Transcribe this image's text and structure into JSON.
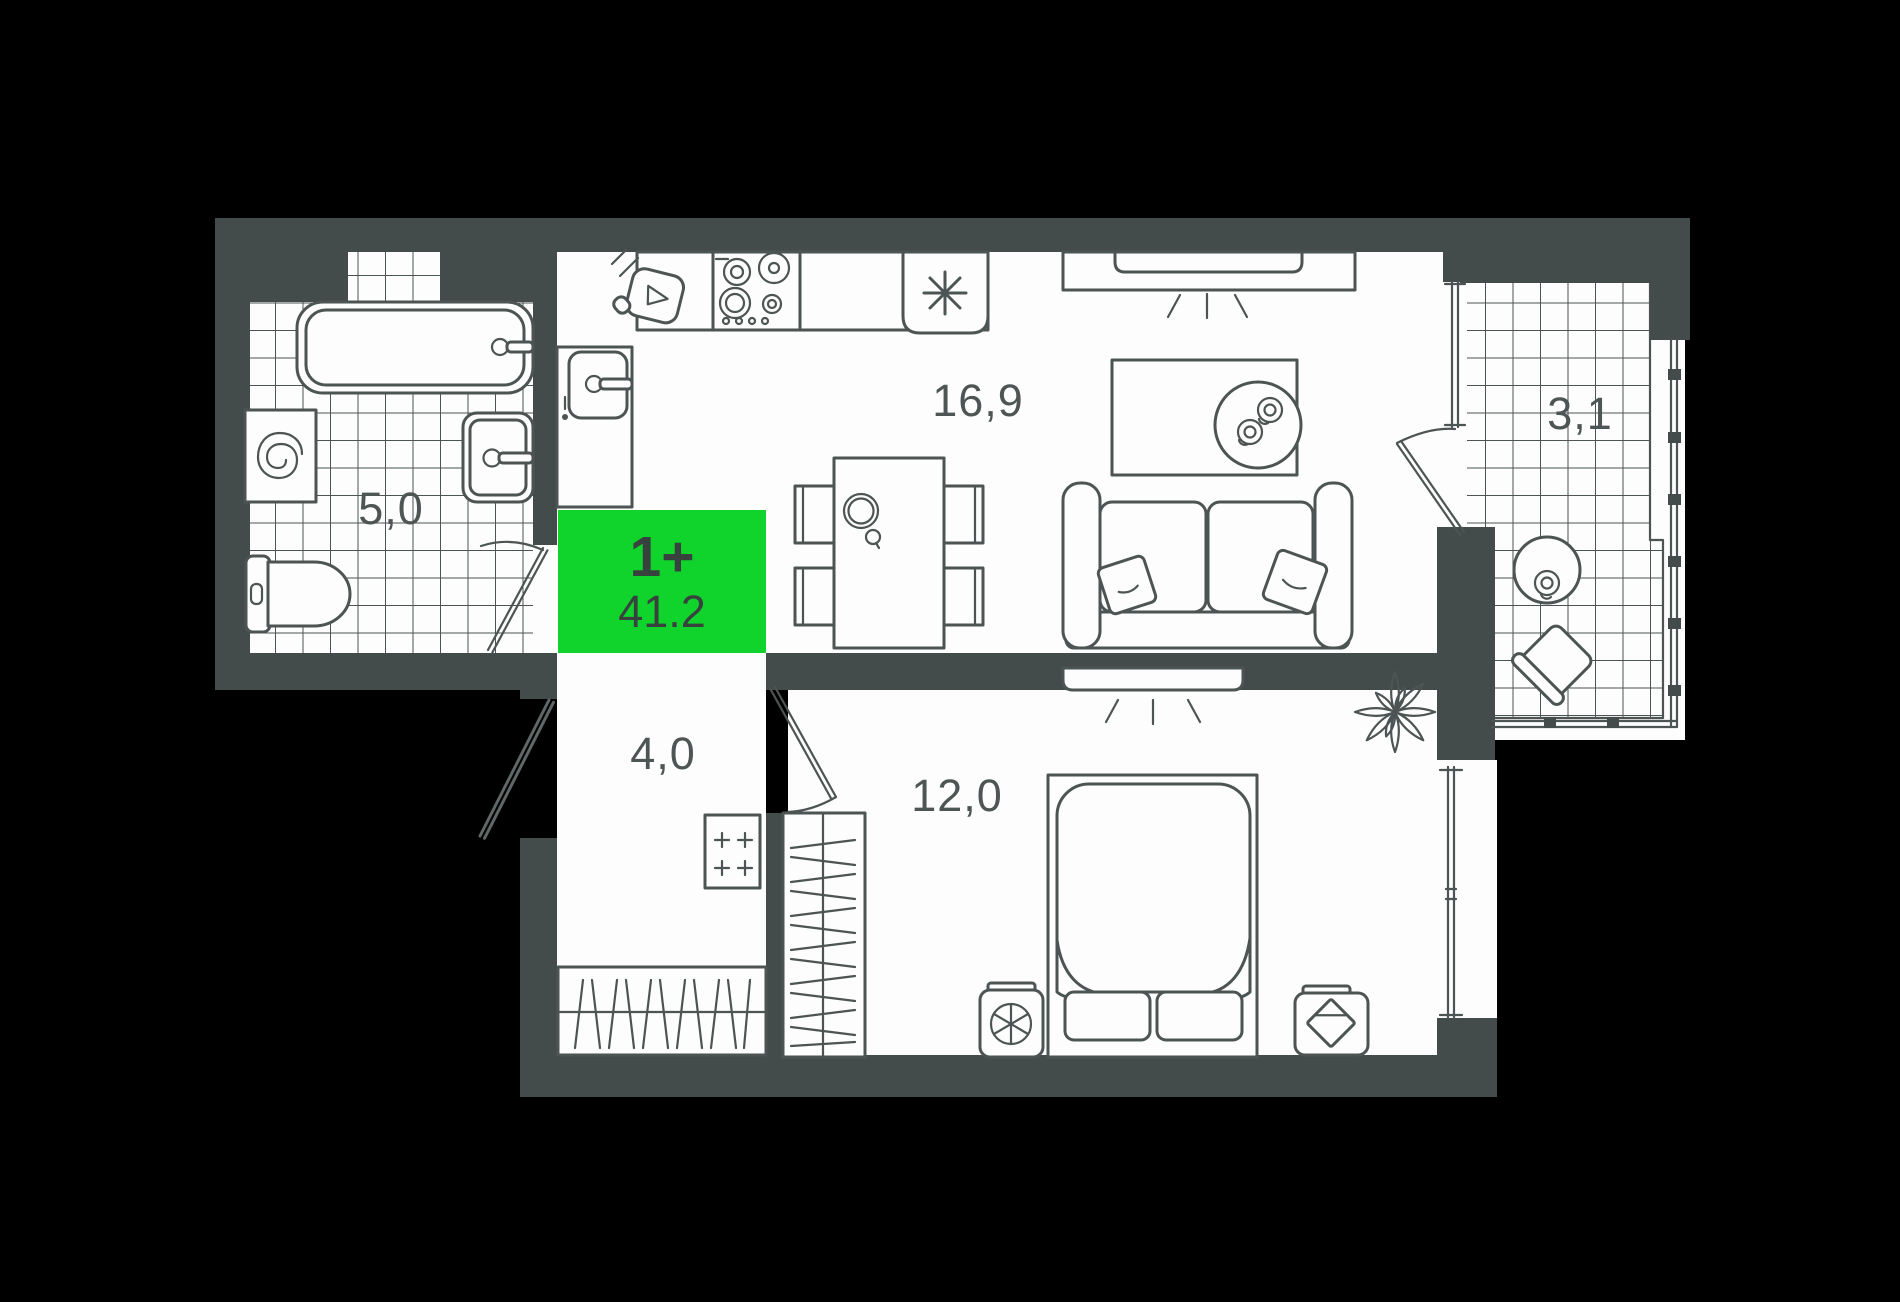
{
  "title": "apartment-floor-plan",
  "badge": {
    "type_label": "1+",
    "area_value": "41.2"
  },
  "rooms": {
    "kitchen_living": {
      "area_label": "16,9"
    },
    "bathroom": {
      "area_label": "5,0"
    },
    "balcony": {
      "area_label": "3,1"
    },
    "hallway": {
      "area_label": "4,0"
    },
    "bedroom": {
      "area_label": "12,0"
    }
  },
  "fixtures": {
    "bathtub-icon": "svg-shape",
    "washing-machine-icon": "svg-spiral-drum",
    "bathroom-sink-icon": "svg-shape",
    "toilet-icon": "svg-shape",
    "kitchen-sink-icon": "svg-shape",
    "cutting-board-icon": "svg-shape",
    "stove-icon": "svg-four-burners",
    "fridge-icon": "svg-asterisk",
    "dining-table-icon": "svg-shape",
    "tv-console-icon": "svg-shape",
    "rug-icon": "svg-shape",
    "coffee-table-icon": "svg-shape",
    "sofa-icon": "svg-shape",
    "bed-icon": "svg-shape",
    "wardrobe-icon": "svg-hatched-rect",
    "closet-icon": "svg-hatched-rect",
    "electrical-panel-icon": "svg-four-plus",
    "plant-icon": "svg-petals",
    "balcony-table-icon": "svg-circle-cup",
    "balcony-chair-icon": "svg-rotated-square",
    "door-swing-icon": "svg-arc"
  },
  "colors": {
    "background": "#000000",
    "wall": "#434c4a",
    "floor": "#fdfdfd",
    "line": "#4c5553",
    "accent_green": "#10d32b",
    "badge_text": "#37423f",
    "label_text": "#4d5654"
  }
}
